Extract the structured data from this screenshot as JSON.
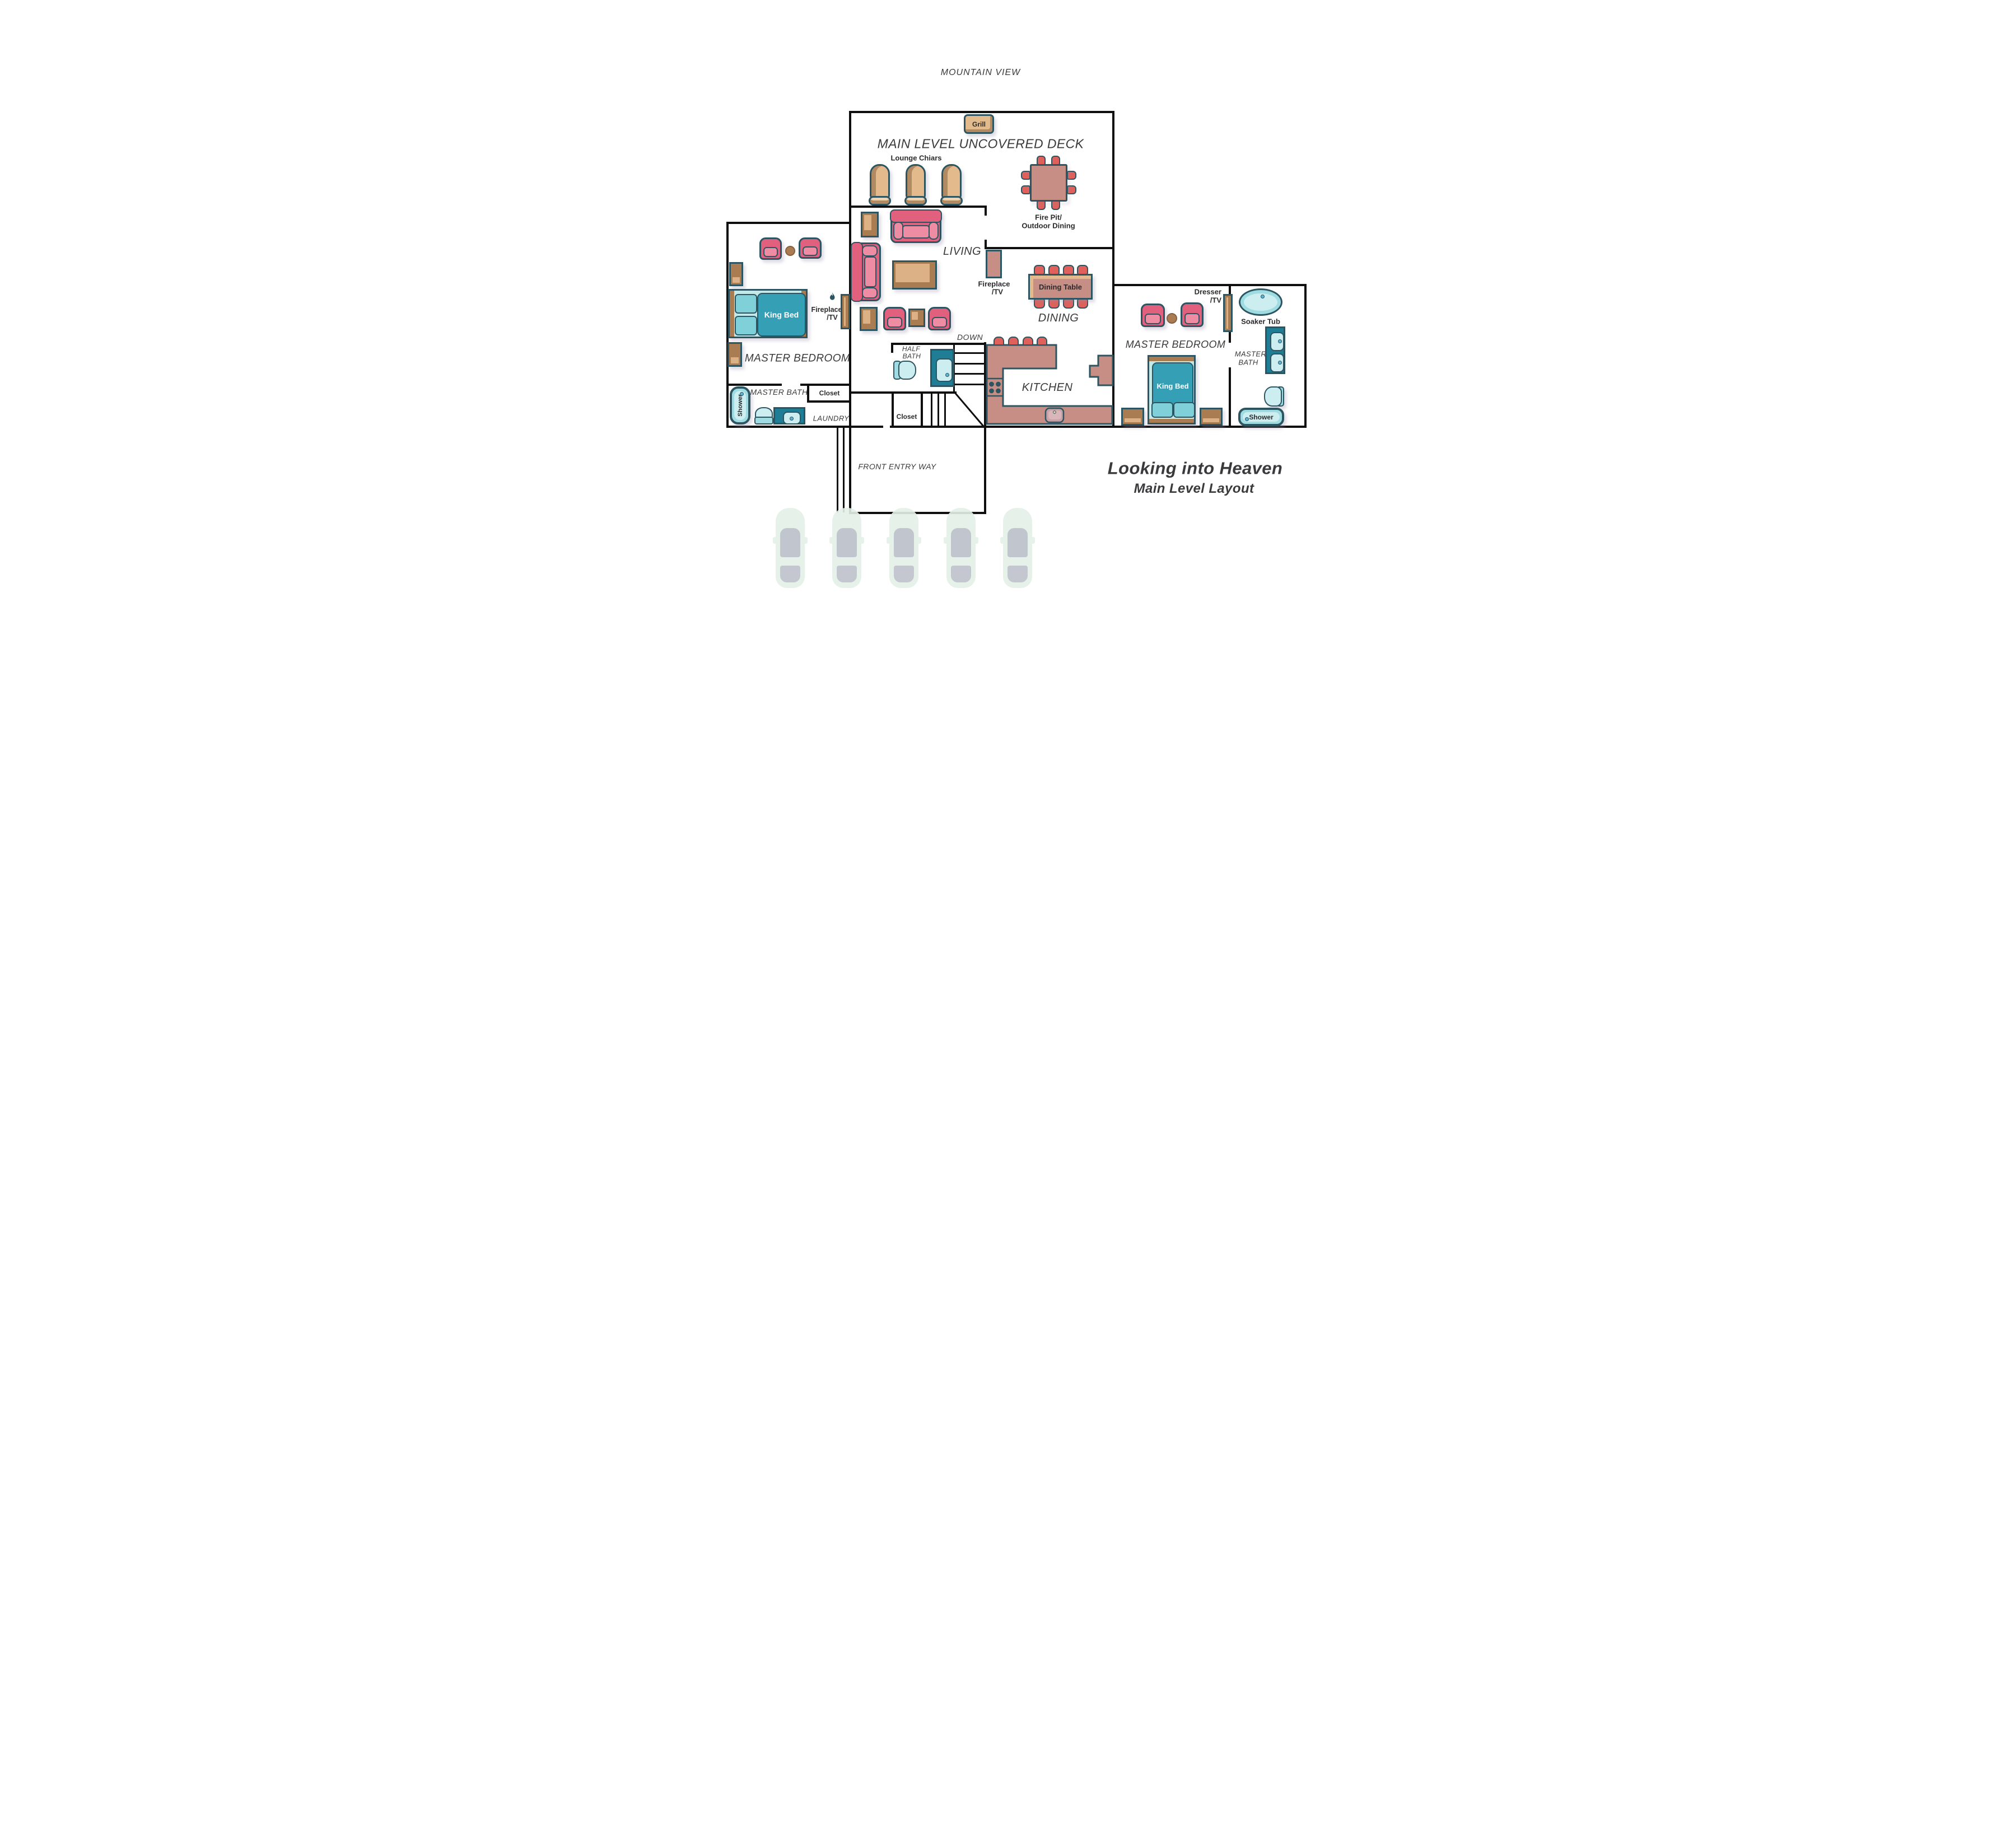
{
  "colors": {
    "wall": "#0f0f0f",
    "line": "#2c5561",
    "ink": "#2b2a2c",
    "room-ink": "#3a393b",
    "white": "#ffffff",
    "mauve": "#c68e84",
    "tan": "#e2ba8c",
    "tan-dark": "#b08a63",
    "tan-light": "#eed3ae",
    "brown": "#a97c52",
    "brown-light": "#dcb185",
    "pink": "#e0607e",
    "pink-light": "#ee8ca4",
    "salmon": "#e0615c",
    "teal-pale": "#cdeef0",
    "teal-mid": "#9fdce2",
    "teal-deep": "#35a0b5",
    "teal-dark": "#1f7e95",
    "bed-pale": "#c2e9ea",
    "pillow": "#7fd0d8",
    "car-body": "#e4f1e7",
    "car-glass": "#b4b6c3"
  },
  "header": {
    "mountain_view": "MOUNTAIN VIEW"
  },
  "deck": {
    "title": "MAIN LEVEL UNCOVERED DECK",
    "grill": "Grill",
    "lounge_chairs": "Lounge Chiars",
    "fire_pit_line1": "Fire Pit/",
    "fire_pit_line2": "Outdoor Dining"
  },
  "living": {
    "label": "LIVING",
    "fireplace_line1": "Fireplace",
    "fireplace_line2": "/TV"
  },
  "dining": {
    "label": "DINING",
    "table": "Dining Table"
  },
  "kitchen": {
    "label": "KITCHEN"
  },
  "stairs": {
    "down": "DOWN",
    "closet": "Closet"
  },
  "half_bath": {
    "line1": "HALF",
    "line2": "BATH"
  },
  "left_suite": {
    "bedroom": "MASTER BEDROOM",
    "bed": "King Bed",
    "fireplace_line1": "Fireplace",
    "fireplace_line2": "/TV",
    "bath": "MASTER BATH",
    "shower": "Shower",
    "closet": "Closet",
    "laundry": "LAUNDRY"
  },
  "entry": {
    "label": "FRONT ENTRY WAY"
  },
  "right_suite": {
    "bedroom": "MASTER BEDROOM",
    "bed": "King Bed",
    "dresser_line1": "Dresser",
    "dresser_line2": "/TV",
    "bath_line1": "MASTER",
    "bath_line2": "BATH",
    "soaker_tub": "Soaker Tub",
    "shower": "Shower"
  },
  "footer": {
    "title": "Looking into Heaven",
    "subtitle": "Main Level Layout"
  }
}
